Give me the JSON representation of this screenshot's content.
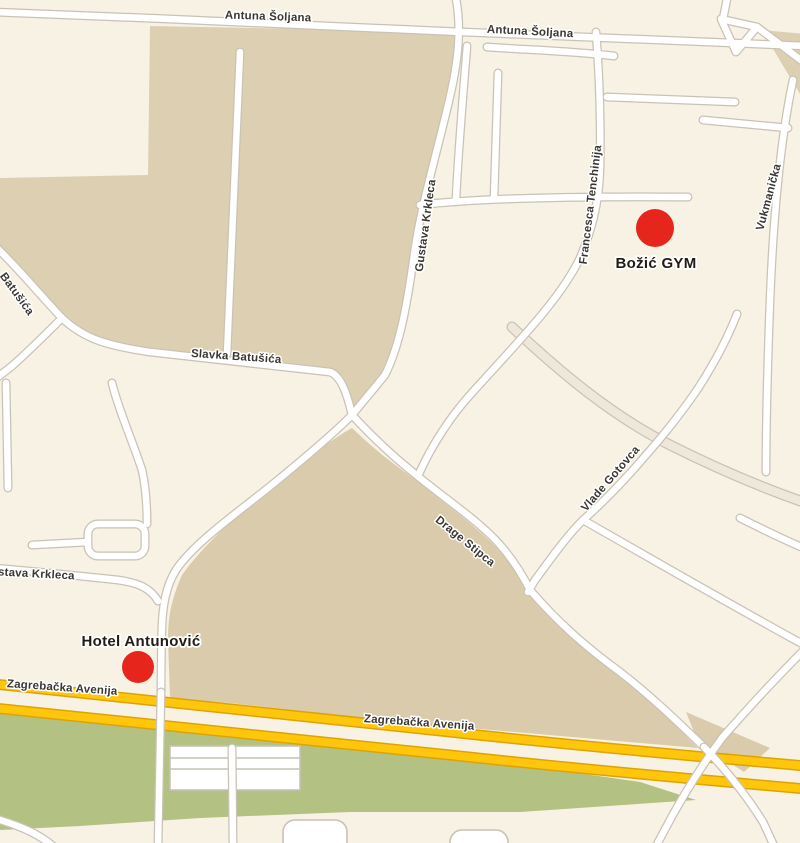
{
  "map": {
    "type": "street-map",
    "pois": [
      {
        "name": "Božić GYM",
        "marker_color": "#e6251d"
      },
      {
        "name": "Hotel Antunović",
        "marker_color": "#e6251d"
      }
    ],
    "streets": {
      "antuna_soljana": "Antuna Šoljana",
      "batusica": "Batušića",
      "slavka_batusica": "Slavka Batušića",
      "gustava_krkleca": "Gustava Krkleca",
      "francesca_tenchinija": "Francesca Tenchinija",
      "vukmanicka": "Vukmanička",
      "drage_stipca": "Drage Stipca",
      "vlade_gotovca": "Vlade Gotovca",
      "zagrebacka_avenija": "Zagrebačka Avenija"
    },
    "colors": {
      "background": "#f7f2e4",
      "block_tan": "#ddd0b2",
      "block_tan_dark": "#d9cbab",
      "green_area": "#b3c183",
      "road_fill": "#ffffff",
      "road_casing": "#c9c2b6",
      "highway_fill": "#ffc60b",
      "highway_casing": "#dda303",
      "label_color": "#3b3833",
      "poi_label_color": "#211c15",
      "marker_red": "#e6251d"
    }
  }
}
